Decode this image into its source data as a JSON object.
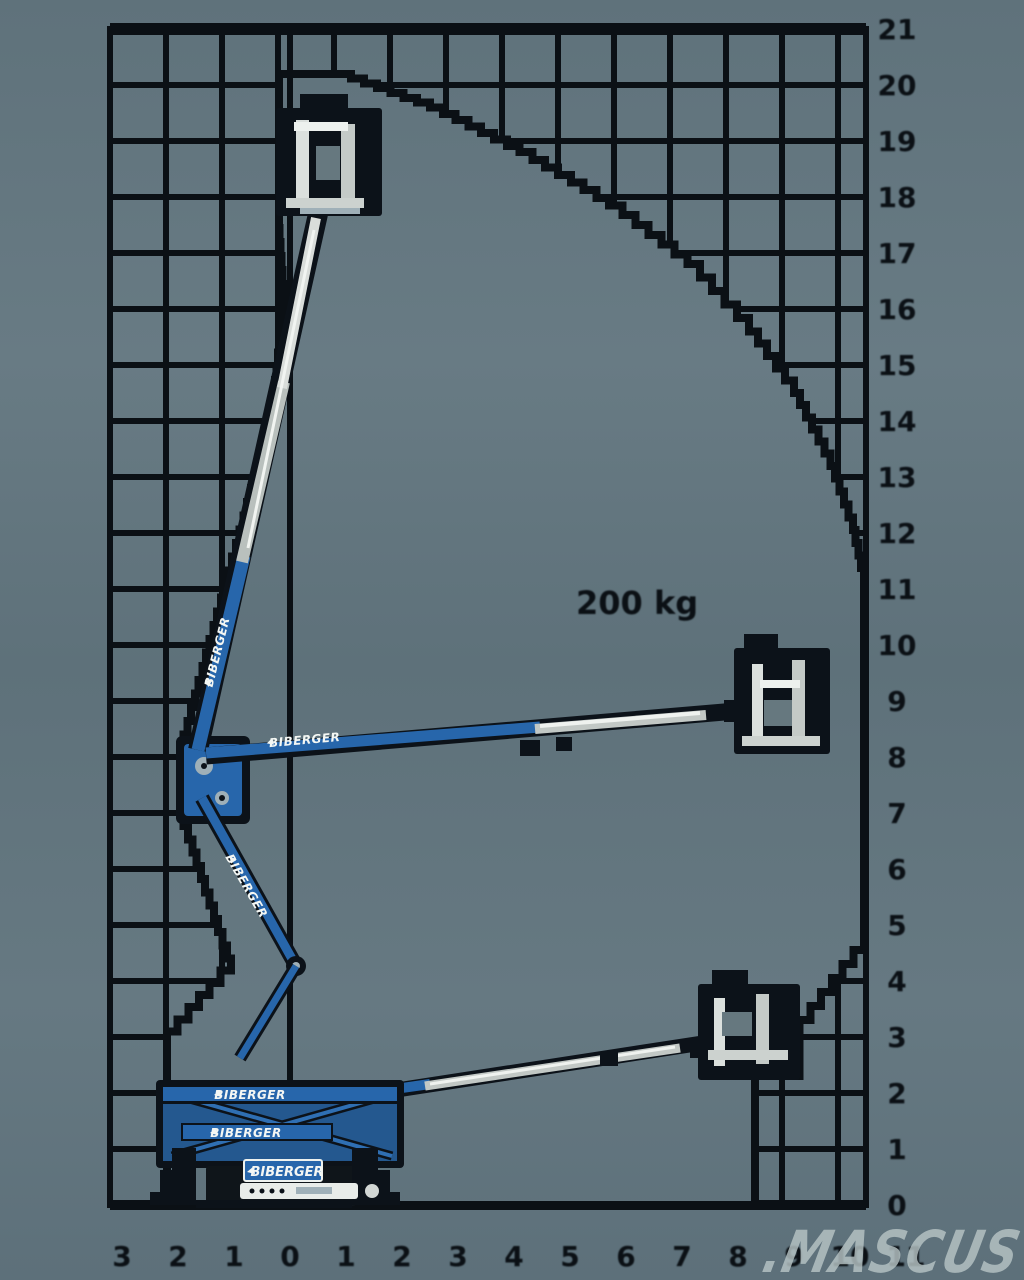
{
  "watermark": ".MASCUS",
  "capacity_label": "200 kg",
  "machine": {
    "brand": "BIBERGER"
  },
  "colors": {
    "background": "#64777f",
    "grid_black": "#0b1015",
    "machine_blue": "#2766ab",
    "machine_blue_dark": "#24588f",
    "machine_light": "#cdd3d0",
    "watermark_gray": "#b7c4c5"
  },
  "chart_data": {
    "type": "area",
    "title": "",
    "xlabel": "",
    "ylabel": "",
    "grid": true,
    "grid_step_m": 1,
    "capacity_kg": 200,
    "x_range_m": [
      -3.2,
      10.3
    ],
    "y_range_m": [
      0,
      21
    ],
    "y_tick_labels": [
      "21",
      "20",
      "19",
      "18",
      "17",
      "16",
      "15",
      "14",
      "13",
      "12",
      "11",
      "10",
      "9",
      "8",
      "7",
      "6",
      "5",
      "4",
      "3",
      "2",
      "1",
      "0"
    ],
    "y_tick_values_m": [
      21,
      20,
      19,
      18,
      17,
      16,
      15,
      14,
      13,
      12,
      11,
      10,
      9,
      8,
      7,
      6,
      5,
      4,
      3,
      2,
      1,
      0
    ],
    "x_tick_labels": [
      "3",
      "2",
      "1",
      "0",
      "1",
      "2",
      "3",
      "4",
      "5",
      "6",
      "7",
      "8",
      "9",
      "10",
      "11"
    ],
    "x_tick_values_m": [
      -3,
      -2,
      -1,
      0,
      1,
      2,
      3,
      4,
      5,
      6,
      7,
      8,
      9,
      10,
      11
    ],
    "envelope_outline_m": [
      [
        -2.2,
        0
      ],
      [
        -2.2,
        3.1
      ],
      [
        -1.05,
        4.4
      ],
      [
        -1.9,
        7.0
      ],
      [
        -1.9,
        8.4
      ],
      [
        -0.7,
        12.8
      ],
      [
        -0.35,
        14.0
      ],
      [
        -0.1,
        16.2
      ],
      [
        -0.2,
        17.7
      ],
      [
        -0.2,
        20.2
      ],
      [
        0.85,
        20.2
      ],
      [
        2.5,
        19.6
      ],
      [
        4.1,
        18.8
      ],
      [
        5.7,
        17.85
      ],
      [
        7.1,
        16.8
      ],
      [
        8.2,
        15.6
      ],
      [
        9.0,
        14.5
      ],
      [
        9.65,
        13.2
      ],
      [
        10.05,
        12.05
      ],
      [
        10.25,
        11.15
      ],
      [
        10.25,
        4.55
      ],
      [
        9.1,
        3.05
      ],
      [
        9.1,
        2.3
      ],
      [
        8.3,
        2.3
      ],
      [
        8.3,
        0
      ]
    ]
  }
}
